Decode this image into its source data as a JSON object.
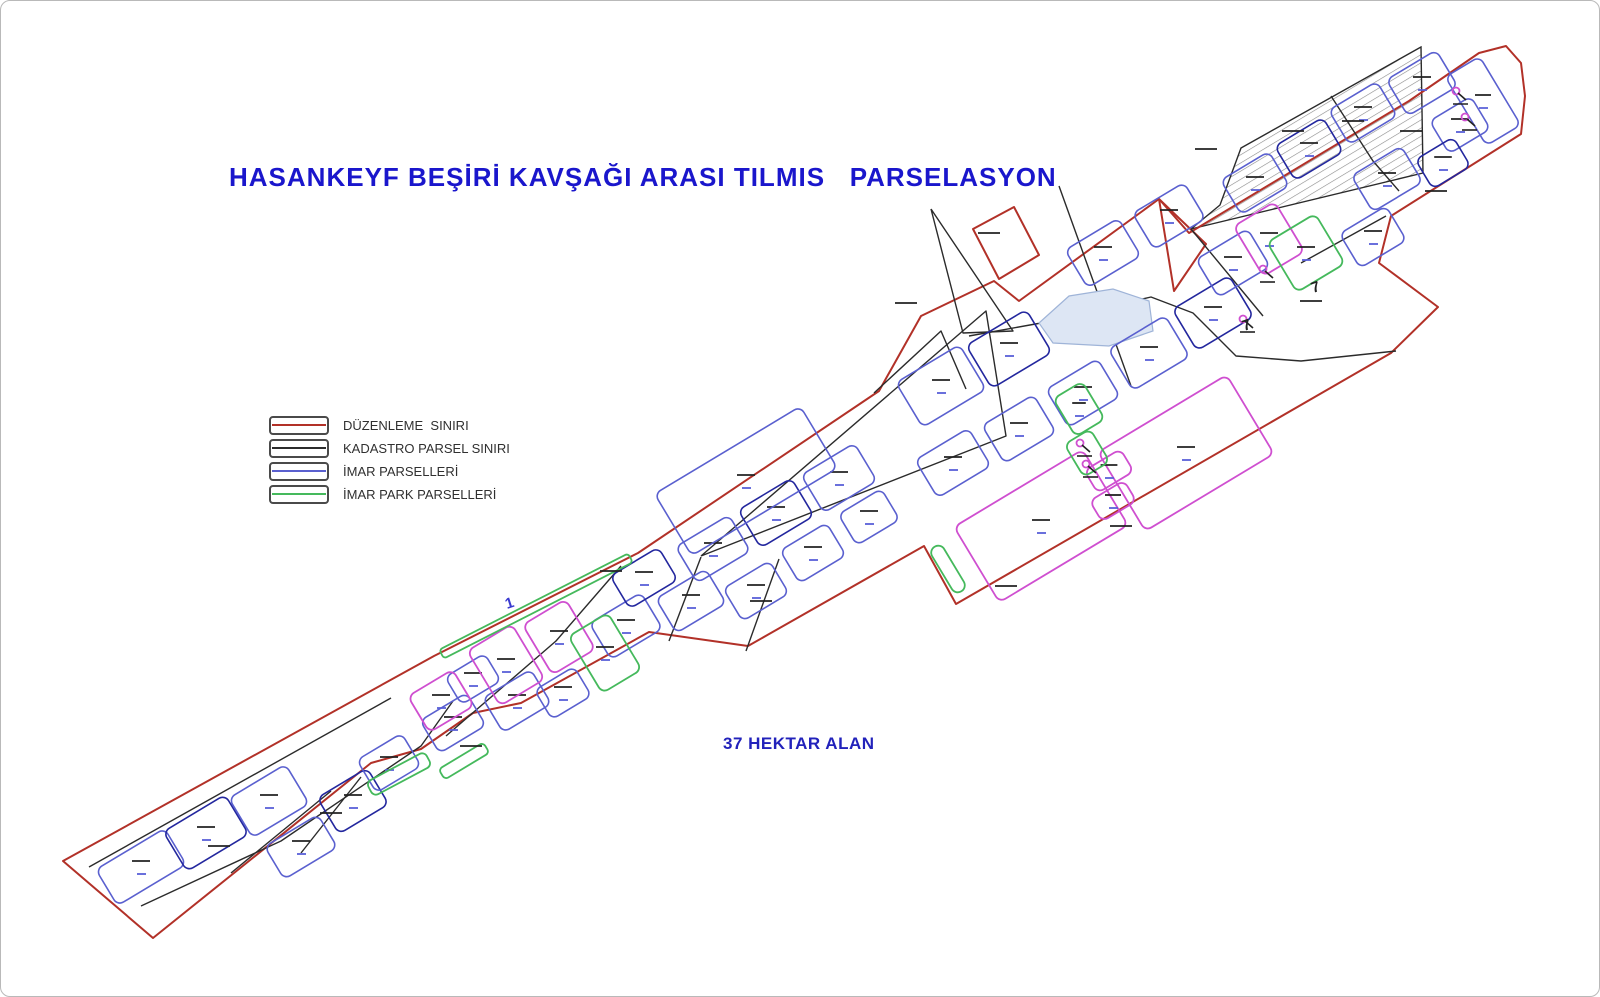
{
  "title": "HASANKEYF BEŞİRİ KAVŞAĞI ARASI TILMIS   PARSELASYON",
  "area_label": "37 HEKTAR ALAN",
  "colors": {
    "title_text": "#1a16cc",
    "area_text": "#2222bb",
    "legend_text": "#303030",
    "boundary": "#b23128",
    "kadastro": "#2b2b2b",
    "imar": "#5a60cf",
    "imar_dark": "#23279e",
    "park": "#45b95c",
    "magenta": "#cf4fd0",
    "pond_fill": "#dde6f4",
    "pond_stroke": "#9fb4d8",
    "hatch_line": "#8a8a8a",
    "dash_black": "#222222",
    "dash_blue": "#5a60d8"
  },
  "legend": {
    "items": [
      {
        "id": "duzenleme-siniri",
        "label": "DÜZENLEME  SINIRI",
        "color": "#b23128"
      },
      {
        "id": "kadastro-parsel-siniri",
        "label": "KADASTRO PARSEL SINIRI",
        "color": "#2b2b2b"
      },
      {
        "id": "imar-parselleri",
        "label": "İMAR PARSELLERİ",
        "color": "#5a60cf"
      },
      {
        "id": "imar-park-parselleri",
        "label": "İMAR PARK PARSELLERİ",
        "color": "#45b95c"
      }
    ]
  },
  "map": {
    "boundary": [
      [
        62,
        860
      ],
      [
        433,
        655
      ],
      [
        637,
        552
      ],
      [
        878,
        390
      ],
      [
        920,
        315
      ],
      [
        993,
        280
      ],
      [
        1018,
        300
      ],
      [
        1158,
        198
      ],
      [
        1188,
        232
      ],
      [
        1408,
        100
      ],
      [
        1478,
        52
      ],
      [
        1505,
        45
      ],
      [
        1520,
        62
      ],
      [
        1524,
        95
      ],
      [
        1520,
        133
      ],
      [
        1390,
        215
      ],
      [
        1378,
        262
      ],
      [
        1437,
        306
      ],
      [
        1390,
        352
      ],
      [
        955,
        603
      ],
      [
        923,
        545
      ],
      [
        747,
        645
      ],
      [
        648,
        631
      ],
      [
        520,
        702
      ],
      [
        472,
        712
      ],
      [
        420,
        748
      ],
      [
        370,
        762
      ],
      [
        152,
        937
      ]
    ],
    "boundary_attachments": [
      [
        [
          972,
          228
        ],
        [
          1013,
          206
        ],
        [
          1038,
          254
        ],
        [
          998,
          278
        ]
      ],
      [
        [
          1158,
          198
        ],
        [
          1205,
          243
        ],
        [
          1173,
          290
        ]
      ]
    ],
    "hatched_parcel": [
      [
        1420,
        46
      ],
      [
        1240,
        147
      ],
      [
        1219,
        204
      ],
      [
        1190,
        228
      ],
      [
        1422,
        172
      ]
    ],
    "kadastro_lines": [
      [
        [
          140,
          905
        ],
        [
          280,
          840
        ],
        [
          420,
          745
        ],
        [
          452,
          700
        ]
      ],
      [
        [
          230,
          872
        ],
        [
          330,
          790
        ]
      ],
      [
        [
          300,
          852
        ],
        [
          360,
          776
        ]
      ],
      [
        [
          88,
          866
        ],
        [
          390,
          697
        ]
      ],
      [
        [
          445,
          735
        ],
        [
          555,
          640
        ],
        [
          620,
          565
        ]
      ],
      [
        [
          668,
          640
        ],
        [
          700,
          556
        ]
      ],
      [
        [
          745,
          650
        ],
        [
          778,
          558
        ]
      ],
      [
        [
          700,
          555
        ],
        [
          985,
          310
        ],
        [
          1005,
          435
        ],
        [
          700,
          555
        ]
      ],
      [
        [
          930,
          208
        ],
        [
          1012,
          330
        ],
        [
          962,
          332
        ],
        [
          930,
          208
        ]
      ],
      [
        [
          1058,
          185
        ],
        [
          1130,
          385
        ]
      ],
      [
        [
          968,
          335
        ],
        [
          1040,
          322
        ],
        [
          1150,
          296
        ],
        [
          1192,
          312
        ],
        [
          1235,
          355
        ],
        [
          1300,
          360
        ],
        [
          1395,
          350
        ]
      ],
      [
        [
          1190,
          228
        ],
        [
          1262,
          315
        ]
      ],
      [
        [
          1330,
          95
        ],
        [
          1372,
          160
        ],
        [
          1398,
          190
        ]
      ],
      [
        [
          873,
          392
        ],
        [
          940,
          330
        ],
        [
          965,
          388
        ]
      ],
      [
        [
          1385,
          215
        ],
        [
          1300,
          262
        ]
      ]
    ],
    "pond": [
      [
        1038,
        322
      ],
      [
        1068,
        295
      ],
      [
        1112,
        288
      ],
      [
        1148,
        300
      ],
      [
        1152,
        330
      ],
      [
        1108,
        345
      ],
      [
        1052,
        342
      ]
    ],
    "parcels": [
      [
        140,
        866,
        80,
        42,
        -31,
        "b"
      ],
      [
        205,
        832,
        72,
        46,
        -31,
        "n"
      ],
      [
        268,
        800,
        66,
        46,
        -31,
        "b"
      ],
      [
        300,
        846,
        62,
        38,
        -31,
        "b"
      ],
      [
        352,
        800,
        58,
        42,
        -31,
        "n"
      ],
      [
        388,
        762,
        52,
        38,
        -31,
        "b"
      ],
      [
        452,
        722,
        54,
        38,
        -31,
        "b"
      ],
      [
        472,
        678,
        46,
        32,
        -31,
        "b"
      ],
      [
        516,
        700,
        56,
        40,
        -31,
        "b"
      ],
      [
        562,
        692,
        46,
        34,
        -31,
        "b"
      ],
      [
        625,
        625,
        60,
        42,
        -31,
        "b"
      ],
      [
        643,
        577,
        56,
        38,
        -31,
        "n"
      ],
      [
        690,
        600,
        58,
        40,
        -31,
        "b"
      ],
      [
        712,
        548,
        62,
        42,
        -31,
        "b"
      ],
      [
        755,
        590,
        54,
        38,
        -31,
        "b"
      ],
      [
        775,
        512,
        62,
        44,
        -31,
        "n"
      ],
      [
        812,
        552,
        54,
        38,
        -31,
        "b"
      ],
      [
        838,
        477,
        62,
        44,
        -31,
        "b"
      ],
      [
        868,
        516,
        50,
        36,
        -31,
        "b"
      ],
      [
        745,
        480,
        170,
        72,
        -31,
        "b"
      ],
      [
        940,
        385,
        74,
        52,
        -31,
        "b"
      ],
      [
        1008,
        348,
        70,
        50,
        -31,
        "n"
      ],
      [
        952,
        462,
        62,
        44,
        -31,
        "b"
      ],
      [
        1018,
        428,
        60,
        44,
        -31,
        "b"
      ],
      [
        1082,
        392,
        60,
        44,
        -31,
        "b"
      ],
      [
        1148,
        352,
        66,
        48,
        -31,
        "b"
      ],
      [
        1212,
        312,
        66,
        48,
        -31,
        "n"
      ],
      [
        1102,
        252,
        62,
        44,
        -31,
        "b"
      ],
      [
        1168,
        215,
        60,
        42,
        -31,
        "b"
      ],
      [
        1232,
        262,
        60,
        44,
        -31,
        "b"
      ],
      [
        1254,
        182,
        56,
        40,
        -31,
        "b"
      ],
      [
        1308,
        148,
        56,
        40,
        -31,
        "n"
      ],
      [
        1362,
        112,
        56,
        40,
        -31,
        "b"
      ],
      [
        1421,
        82,
        58,
        42,
        -31,
        "b"
      ],
      [
        1459,
        124,
        48,
        38,
        -31,
        "b"
      ],
      [
        1386,
        178,
        58,
        42,
        -31,
        "b"
      ],
      [
        1442,
        162,
        44,
        34,
        -31,
        "n"
      ],
      [
        1372,
        236,
        54,
        40,
        -31,
        "b"
      ],
      [
        1482,
        100,
        40,
        80,
        -31,
        "b"
      ],
      [
        505,
        664,
        52,
        64,
        -31,
        "m"
      ],
      [
        558,
        636,
        50,
        58,
        -31,
        "m"
      ],
      [
        440,
        700,
        52,
        42,
        -31,
        "m"
      ],
      [
        1040,
        525,
        150,
        88,
        -31,
        "m"
      ],
      [
        1185,
        452,
        150,
        92,
        -31,
        "m"
      ],
      [
        1108,
        470,
        42,
        26,
        -31,
        "m"
      ],
      [
        1112,
        500,
        40,
        24,
        -31,
        "m"
      ],
      [
        1268,
        238,
        48,
        58,
        -31,
        "m"
      ],
      [
        604,
        652,
        46,
        66,
        -31,
        "g"
      ],
      [
        947,
        568,
        14,
        52,
        -31,
        "g"
      ],
      [
        1078,
        408,
        34,
        44,
        -31,
        "g"
      ],
      [
        1086,
        452,
        30,
        38,
        -31,
        "g"
      ],
      [
        1305,
        252,
        56,
        58,
        -31,
        "g"
      ],
      [
        398,
        773,
        66,
        16,
        -28,
        "g"
      ],
      [
        535,
        605,
        212,
        10,
        -27,
        "g"
      ],
      [
        463,
        760,
        52,
        12,
        -31,
        "g"
      ]
    ],
    "label_dashes": [
      [
        1292,
        130
      ],
      [
        1205,
        148
      ],
      [
        1352,
        120
      ],
      [
        988,
        232
      ],
      [
        905,
        302
      ],
      [
        610,
        570
      ],
      [
        330,
        812
      ],
      [
        218,
        845
      ],
      [
        1005,
        585
      ],
      [
        1120,
        525
      ],
      [
        760,
        600
      ],
      [
        470,
        745
      ],
      [
        1410,
        130
      ],
      [
        1435,
        190
      ],
      [
        1310,
        300
      ]
    ],
    "symbol_marks": [
      [
        1079,
        442
      ],
      [
        1262,
        268
      ],
      [
        1455,
        90
      ],
      [
        1464,
        116
      ],
      [
        1242,
        318
      ],
      [
        1085,
        463
      ]
    ],
    "text_glyphs": [
      {
        "t": "1",
        "x": 506,
        "y": 608,
        "c": "#3a3ad0"
      },
      {
        "t": "7",
        "x": 1243,
        "y": 330,
        "c": "#222222"
      },
      {
        "t": "7",
        "x": 1312,
        "y": 292,
        "c": "#222222"
      }
    ]
  }
}
